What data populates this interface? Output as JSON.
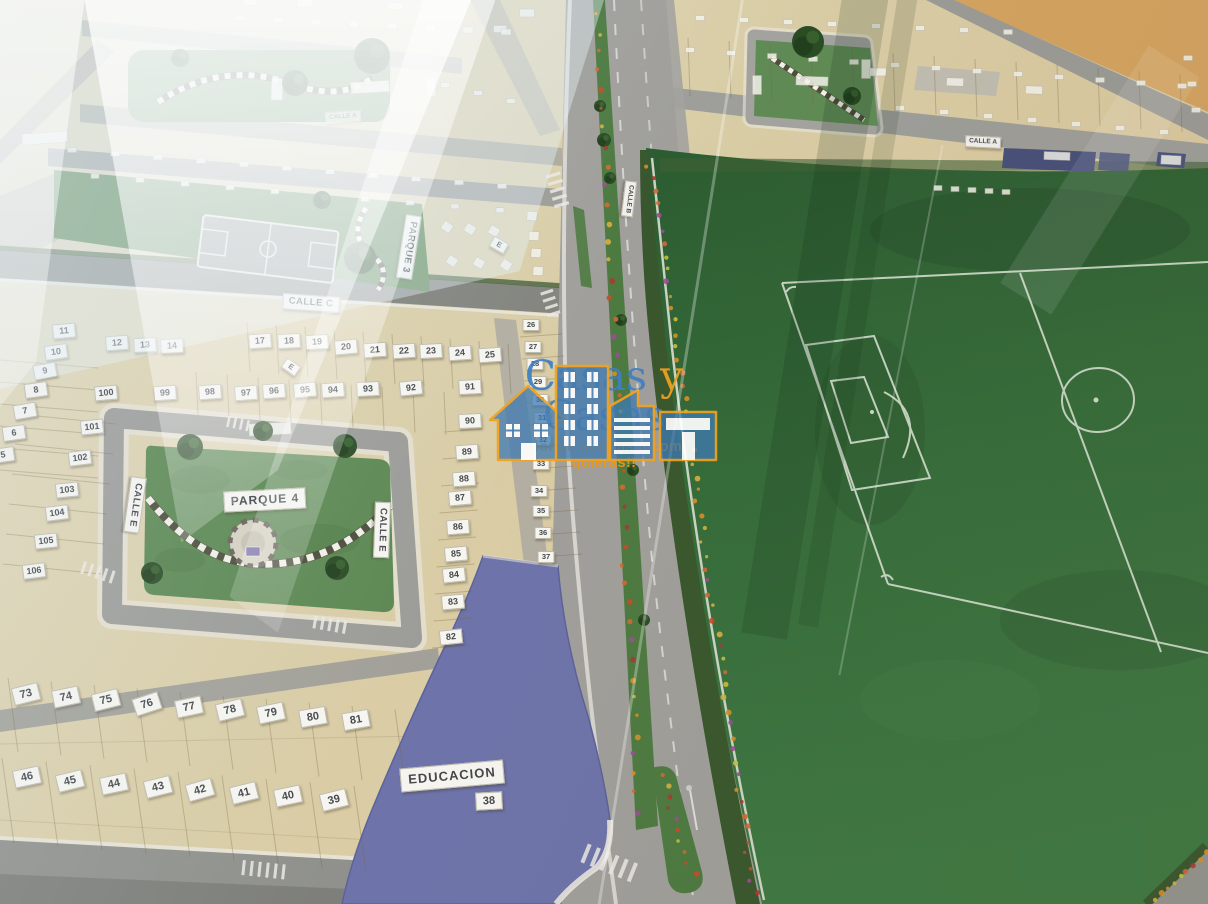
{
  "brand": {
    "word1": "Casas",
    "conjunction": "y",
    "word2": "Casas",
    "tagline": "...donde quieras y como quieras!!",
    "brand_color": "#3f7fc4",
    "accent_color": "#f2a21f"
  },
  "colors": {
    "base_beige": "#d9cda9",
    "field_green": "#356c3a",
    "park_green": "#5c8852",
    "road_gray": "#9c9c98",
    "education_purple": "#6e74aa",
    "plaque_white": "#f6f5f0",
    "navy_lot": "#47507a"
  },
  "street_labels": [
    {
      "text": "CALLE A",
      "x": 343,
      "y": 117,
      "r": -4,
      "c": "stsm",
      "o": 0.6
    },
    {
      "text": "CALLE A",
      "x": 983,
      "y": 142,
      "r": 3,
      "c": "stsm",
      "o": 0.95
    },
    {
      "text": "CALLE B",
      "x": 629,
      "y": 199,
      "r": 97,
      "c": "stsm",
      "o": 0.95
    },
    {
      "text": "CALLE C",
      "x": 311,
      "y": 303,
      "r": 4,
      "c": "st"
    },
    {
      "text": "CALLE E",
      "x": 135,
      "y": 505,
      "r": 98,
      "c": "st"
    },
    {
      "text": "CALLE E",
      "x": 382,
      "y": 530,
      "r": 92,
      "c": "st"
    },
    {
      "text": "PARQUE 3",
      "x": 409,
      "y": 247,
      "r": 99,
      "c": "st"
    },
    {
      "text": "PARQUE 4",
      "x": 265,
      "y": 500,
      "r": -3,
      "c": "p4"
    },
    {
      "text": "EDUCACION",
      "x": 452,
      "y": 776,
      "r": -5,
      "c": "xl"
    }
  ],
  "letter_plaques": [
    {
      "text": "E",
      "x": 291,
      "y": 367,
      "r": 35
    },
    {
      "text": "E",
      "x": 499,
      "y": 245,
      "r": 30
    }
  ],
  "lot_numbers": [
    {
      "n": "11",
      "x": 64,
      "y": 331,
      "r": -5,
      "c": "md"
    },
    {
      "n": "12",
      "x": 117,
      "y": 343,
      "r": -4,
      "c": "md"
    },
    {
      "n": "13",
      "x": 145,
      "y": 345,
      "r": -3,
      "c": "md"
    },
    {
      "n": "14",
      "x": 172,
      "y": 346,
      "r": -3,
      "c": "md"
    },
    {
      "n": "10",
      "x": 56,
      "y": 352,
      "r": -8,
      "c": "md"
    },
    {
      "n": "9",
      "x": 45,
      "y": 371,
      "r": -10,
      "c": "md"
    },
    {
      "n": "8",
      "x": 36,
      "y": 390,
      "r": -8,
      "c": "md"
    },
    {
      "n": "7",
      "x": 25,
      "y": 411,
      "r": -10,
      "c": "md"
    },
    {
      "n": "6",
      "x": 14,
      "y": 433,
      "r": -8,
      "c": "md"
    },
    {
      "n": "5",
      "x": 3,
      "y": 455,
      "r": -8,
      "c": "md"
    },
    {
      "n": "100",
      "x": 106,
      "y": 393,
      "r": -5,
      "c": "md"
    },
    {
      "n": "99",
      "x": 165,
      "y": 393,
      "r": -4,
      "c": "md"
    },
    {
      "n": "101",
      "x": 92,
      "y": 427,
      "r": -6,
      "c": "md"
    },
    {
      "n": "102",
      "x": 80,
      "y": 458,
      "r": -7,
      "c": "md"
    },
    {
      "n": "103",
      "x": 67,
      "y": 490,
      "r": -6,
      "c": "md"
    },
    {
      "n": "104",
      "x": 57,
      "y": 513,
      "r": -7,
      "c": "md"
    },
    {
      "n": "105",
      "x": 46,
      "y": 541,
      "r": -6,
      "c": "md"
    },
    {
      "n": "106",
      "x": 34,
      "y": 571,
      "r": -7,
      "c": "md"
    },
    {
      "n": "17",
      "x": 260,
      "y": 341,
      "r": -4,
      "c": "md"
    },
    {
      "n": "18",
      "x": 289,
      "y": 341,
      "r": -3,
      "c": "md"
    },
    {
      "n": "19",
      "x": 317,
      "y": 342,
      "r": -3,
      "c": "md"
    },
    {
      "n": "20",
      "x": 346,
      "y": 347,
      "r": -5,
      "c": "md"
    },
    {
      "n": "21",
      "x": 375,
      "y": 350,
      "r": -4,
      "c": "md"
    },
    {
      "n": "22",
      "x": 404,
      "y": 351,
      "r": -4,
      "c": "md"
    },
    {
      "n": "23",
      "x": 431,
      "y": 351,
      "r": -3,
      "c": "md"
    },
    {
      "n": "24",
      "x": 460,
      "y": 353,
      "r": -4,
      "c": "md"
    },
    {
      "n": "25",
      "x": 490,
      "y": 355,
      "r": -4,
      "c": "md"
    },
    {
      "n": "98",
      "x": 210,
      "y": 392,
      "r": -4,
      "c": "md"
    },
    {
      "n": "97",
      "x": 246,
      "y": 393,
      "r": -4,
      "c": "md"
    },
    {
      "n": "96",
      "x": 274,
      "y": 391,
      "r": -4,
      "c": "md"
    },
    {
      "n": "95",
      "x": 305,
      "y": 390,
      "r": -5,
      "c": "md"
    },
    {
      "n": "94",
      "x": 333,
      "y": 390,
      "r": -4,
      "c": "md"
    },
    {
      "n": "93",
      "x": 368,
      "y": 389,
      "r": -3,
      "c": "md"
    },
    {
      "n": "92",
      "x": 411,
      "y": 388,
      "r": -6,
      "c": "md"
    },
    {
      "n": "91",
      "x": 470,
      "y": 387,
      "r": -3,
      "c": "md"
    },
    {
      "n": "26",
      "x": 531,
      "y": 325,
      "r": 0,
      "c": "sm"
    },
    {
      "n": "27",
      "x": 533,
      "y": 347,
      "r": 0,
      "c": "sm"
    },
    {
      "n": "28",
      "x": 535,
      "y": 364,
      "r": 0,
      "c": "sm"
    },
    {
      "n": "29",
      "x": 538,
      "y": 382,
      "r": 0,
      "c": "sm"
    },
    {
      "n": "30",
      "x": 540,
      "y": 400,
      "r": 0,
      "c": "sm"
    },
    {
      "n": "31",
      "x": 542,
      "y": 418,
      "r": 0,
      "c": "sm"
    },
    {
      "n": "32",
      "x": 543,
      "y": 440,
      "r": 0,
      "c": "sm"
    },
    {
      "n": "33",
      "x": 541,
      "y": 464,
      "r": 0,
      "c": "sm"
    },
    {
      "n": "34",
      "x": 539,
      "y": 491,
      "r": 0,
      "c": "sm"
    },
    {
      "n": "35",
      "x": 541,
      "y": 511,
      "r": 0,
      "c": "sm"
    },
    {
      "n": "36",
      "x": 543,
      "y": 533,
      "r": 0,
      "c": "sm"
    },
    {
      "n": "37",
      "x": 546,
      "y": 557,
      "r": 0,
      "c": "sm"
    },
    {
      "n": "90",
      "x": 470,
      "y": 421,
      "r": -3,
      "c": "md"
    },
    {
      "n": "89",
      "x": 467,
      "y": 452,
      "r": -4,
      "c": "md"
    },
    {
      "n": "88",
      "x": 464,
      "y": 479,
      "r": -4,
      "c": "md"
    },
    {
      "n": "87",
      "x": 460,
      "y": 498,
      "r": -5,
      "c": "md"
    },
    {
      "n": "86",
      "x": 458,
      "y": 527,
      "r": -4,
      "c": "md"
    },
    {
      "n": "85",
      "x": 456,
      "y": 554,
      "r": -5,
      "c": "md"
    },
    {
      "n": "84",
      "x": 454,
      "y": 575,
      "r": -6,
      "c": "md"
    },
    {
      "n": "83",
      "x": 453,
      "y": 602,
      "r": -5,
      "c": "md"
    },
    {
      "n": "82",
      "x": 451,
      "y": 637,
      "r": -6,
      "c": "md"
    },
    {
      "n": "73",
      "x": 26,
      "y": 694,
      "r": -14,
      "c": "lg"
    },
    {
      "n": "74",
      "x": 66,
      "y": 697,
      "r": -12,
      "c": "lg"
    },
    {
      "n": "75",
      "x": 106,
      "y": 700,
      "r": -14,
      "c": "lg"
    },
    {
      "n": "76",
      "x": 147,
      "y": 704,
      "r": -18,
      "c": "lg"
    },
    {
      "n": "77",
      "x": 189,
      "y": 707,
      "r": -12,
      "c": "lg"
    },
    {
      "n": "78",
      "x": 230,
      "y": 710,
      "r": -14,
      "c": "lg"
    },
    {
      "n": "79",
      "x": 271,
      "y": 713,
      "r": -12,
      "c": "lg"
    },
    {
      "n": "80",
      "x": 313,
      "y": 717,
      "r": -10,
      "c": "lg"
    },
    {
      "n": "81",
      "x": 356,
      "y": 720,
      "r": -10,
      "c": "lg"
    },
    {
      "n": "46",
      "x": 27,
      "y": 777,
      "r": -12,
      "c": "lg"
    },
    {
      "n": "45",
      "x": 70,
      "y": 781,
      "r": -14,
      "c": "lg"
    },
    {
      "n": "44",
      "x": 114,
      "y": 784,
      "r": -12,
      "c": "lg"
    },
    {
      "n": "43",
      "x": 158,
      "y": 787,
      "r": -14,
      "c": "lg"
    },
    {
      "n": "42",
      "x": 200,
      "y": 790,
      "r": -16,
      "c": "lg"
    },
    {
      "n": "41",
      "x": 244,
      "y": 793,
      "r": -14,
      "c": "lg"
    },
    {
      "n": "40",
      "x": 288,
      "y": 796,
      "r": -12,
      "c": "lg"
    },
    {
      "n": "39",
      "x": 334,
      "y": 800,
      "r": -14,
      "c": "lg"
    },
    {
      "n": "38",
      "x": 489,
      "y": 801,
      "r": -3,
      "c": "lg"
    }
  ]
}
